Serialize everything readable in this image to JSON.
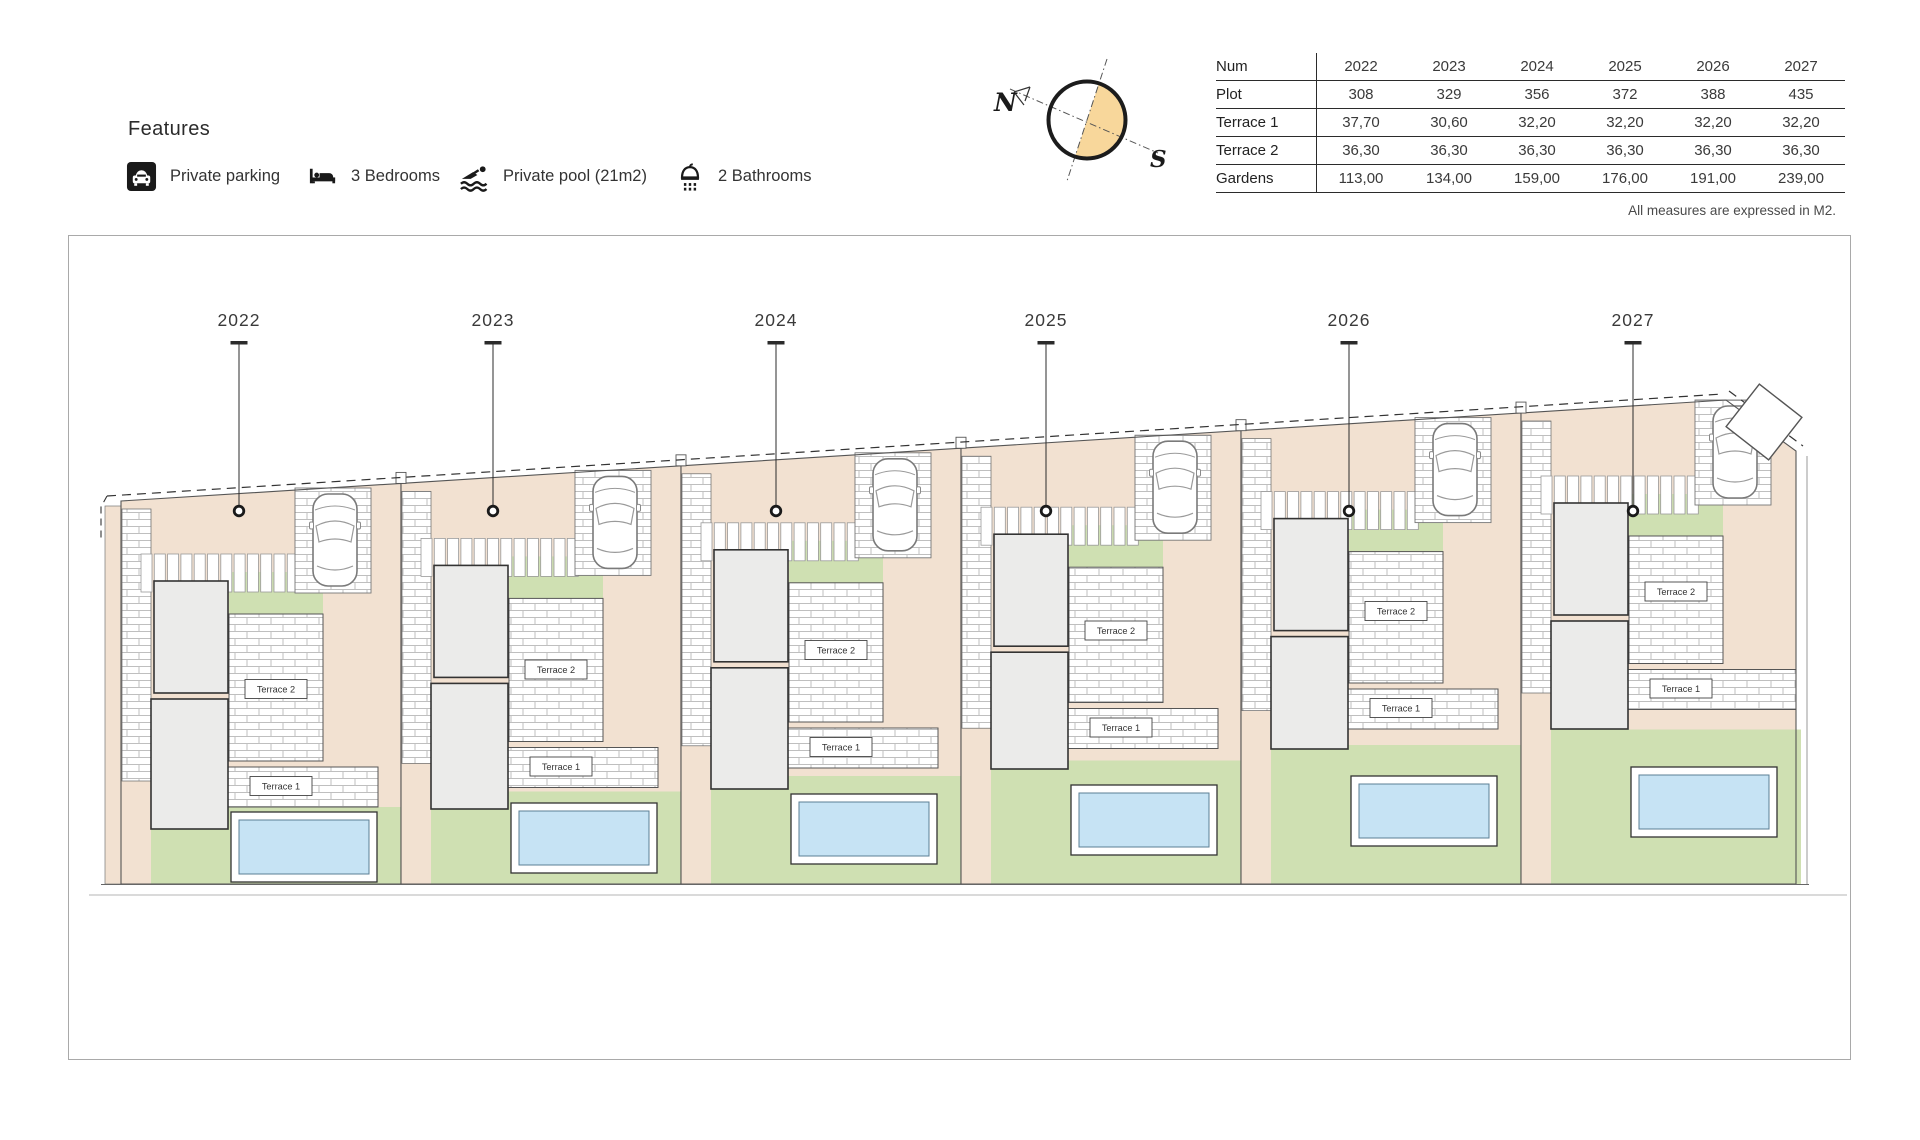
{
  "features": {
    "title": "Features",
    "items": [
      {
        "icon": "parking-icon",
        "label": "Private parking"
      },
      {
        "icon": "bed-icon",
        "label": "3 Bedrooms"
      },
      {
        "icon": "pool-icon",
        "label": "Private pool (21m2)"
      },
      {
        "icon": "shower-icon",
        "label": "2 Bathrooms"
      }
    ]
  },
  "compass": {
    "north_label": "N",
    "south_label": "S",
    "fill_color": "#F8D79B"
  },
  "table": {
    "header": [
      "Num",
      "2022",
      "2023",
      "2024",
      "2025",
      "2026",
      "2027"
    ],
    "rows": [
      {
        "label": "Plot",
        "values": [
          "308",
          "329",
          "356",
          "372",
          "388",
          "435"
        ]
      },
      {
        "label": "Terrace 1",
        "values": [
          "37,70",
          "30,60",
          "32,20",
          "32,20",
          "32,20",
          "32,20"
        ]
      },
      {
        "label": "Terrace 2",
        "values": [
          "36,30",
          "36,30",
          "36,30",
          "36,30",
          "36,30",
          "36,30"
        ]
      },
      {
        "label": "Gardens",
        "values": [
          "113,00",
          "134,00",
          "159,00",
          "176,00",
          "191,00",
          "239,00"
        ]
      }
    ],
    "note": "All measures are expressed in M2."
  },
  "site_plan": {
    "years": [
      "2022",
      "2023",
      "2024",
      "2025",
      "2026",
      "2027"
    ],
    "terrace2_label": "Terrace 2",
    "terrace1_label": "Terrace 1",
    "colors": {
      "ground": "#F2E1D1",
      "garden": "#CFE0B2",
      "pool_water": "#C6E3F4",
      "house_fill": "#EBEBEA",
      "brick_line": "#BFBFBF",
      "outline": "#555555"
    }
  }
}
